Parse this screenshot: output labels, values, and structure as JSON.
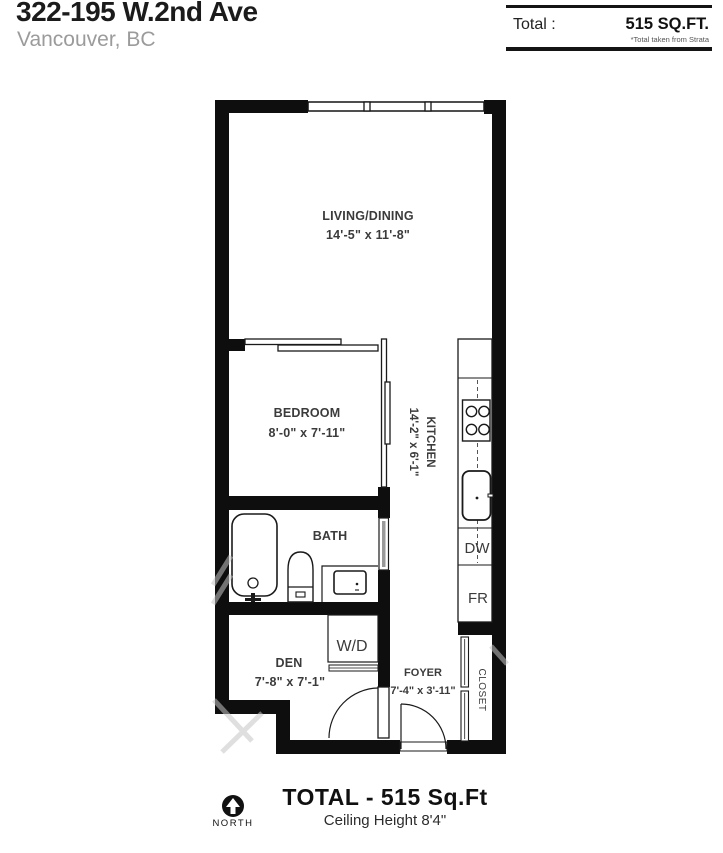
{
  "header": {
    "address": "322-195 W.2nd Ave",
    "city": "Vancouver, BC",
    "total_label": "Total :",
    "total_value": "515 SQ.FT.",
    "total_note": "*Total taken from Strata"
  },
  "rooms": {
    "living": {
      "name": "LIVING/DINING",
      "dims": "14'-5\" x 11'-8\""
    },
    "bedroom": {
      "name": "BEDROOM",
      "dims": "8'-0\" x 7'-11\""
    },
    "kitchen": {
      "name": "KITCHEN",
      "dims": "14'-2\" x 6'-1\""
    },
    "bath": {
      "name": "BATH"
    },
    "den": {
      "name": "DEN",
      "dims": "7'-8\" x 7'-1\""
    },
    "foyer": {
      "name": "FOYER",
      "dims": "7'-4\" x 3'-11\""
    },
    "closet": {
      "name": "CLOSET"
    },
    "wd": {
      "name": "W/D"
    },
    "dw": {
      "name": "DW"
    },
    "fr": {
      "name": "FR"
    }
  },
  "footer": {
    "north": "NORTH",
    "total": "TOTAL  -  515 Sq.Ft",
    "ceiling": "Ceiling Height 8'4\""
  },
  "colors": {
    "wall": "#0e0e0e",
    "line": "#1a1a1a",
    "label": "#3b3b3b",
    "muted": "#9b9b9b"
  }
}
